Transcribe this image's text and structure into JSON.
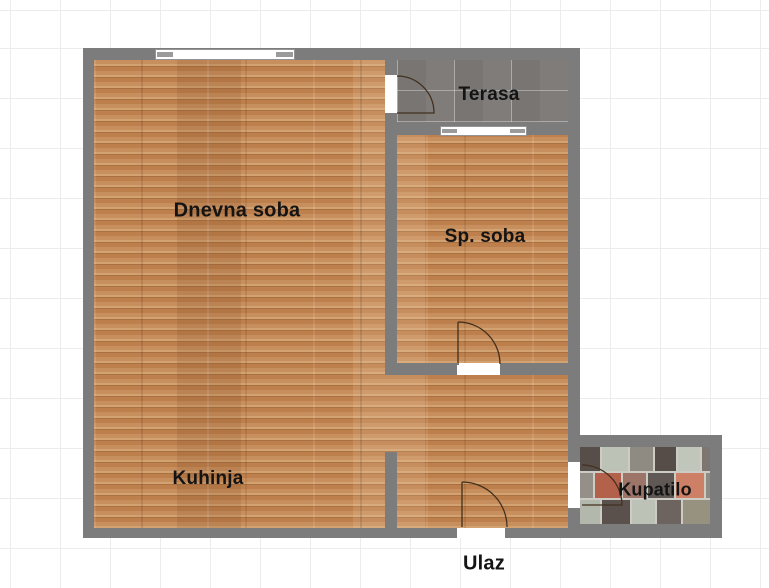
{
  "floorplan": {
    "rooms": [
      {
        "id": "dnevna-soba",
        "label": "Dnevna soba"
      },
      {
        "id": "terasa",
        "label": "Terasa"
      },
      {
        "id": "sp-soba",
        "label": "Sp. soba"
      },
      {
        "id": "kuhinja",
        "label": "Kuhinja"
      },
      {
        "id": "kupatilo",
        "label": "Kupatilo"
      },
      {
        "id": "ulaz",
        "label": "Ulaz"
      }
    ],
    "colors": {
      "wall": "#7c7c7c",
      "wood_floor": "#c58a5a",
      "terrace_tile": "#807c7a",
      "background": "#ffffff",
      "grid_line": "#ececec",
      "label_text": "#141414"
    }
  }
}
